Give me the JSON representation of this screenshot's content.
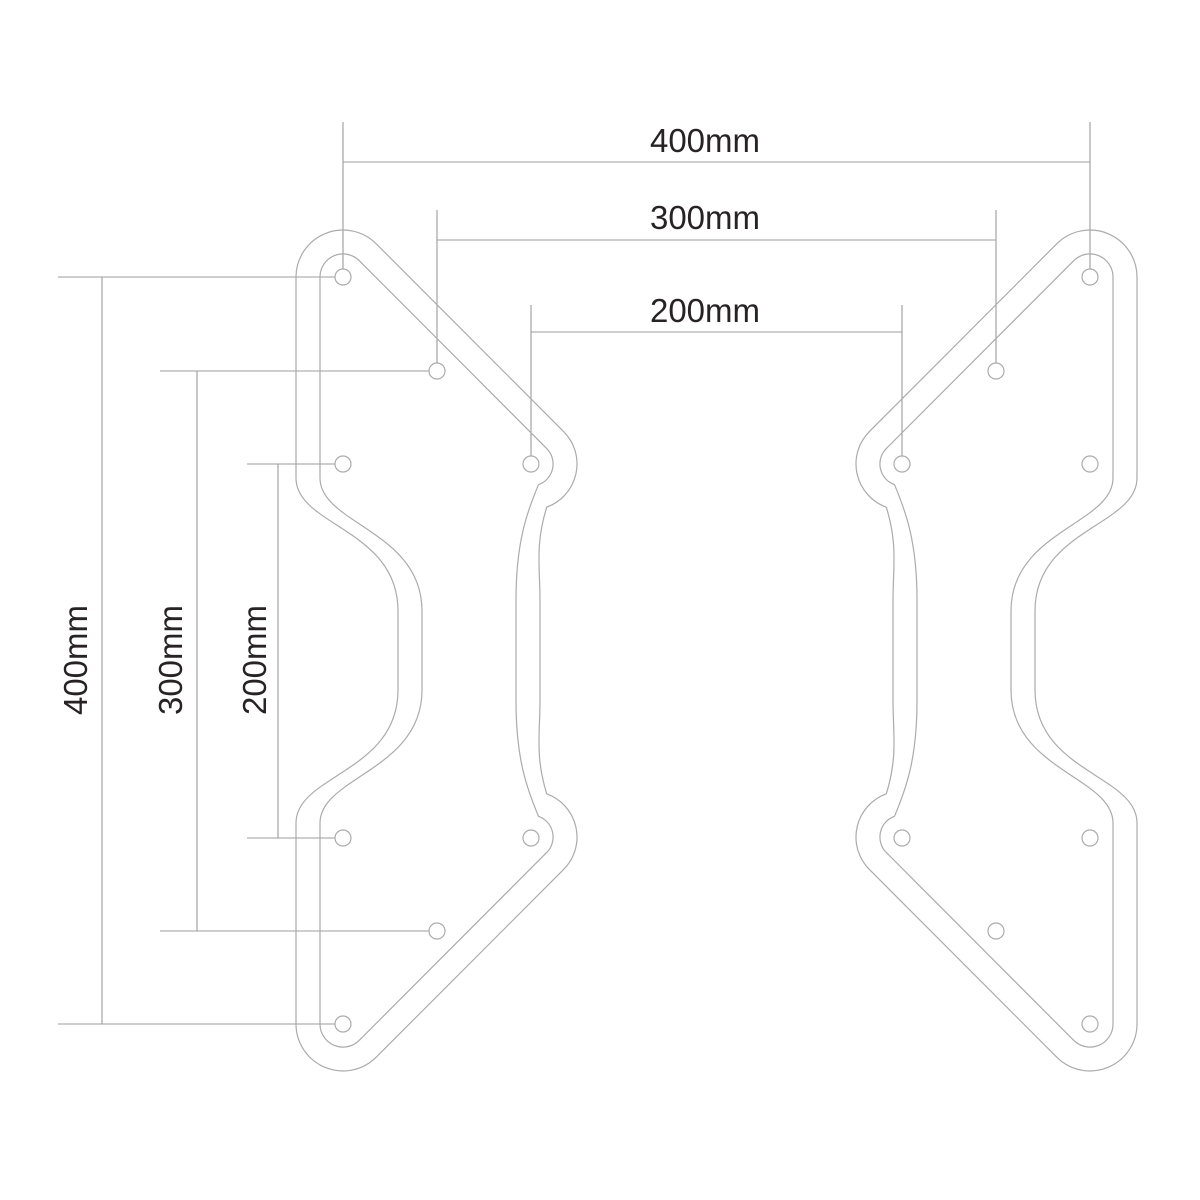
{
  "diagram": {
    "unit": "mm",
    "colors": {
      "background": "#ffffff",
      "plate_outline": "#ababab",
      "dimension_line": "#9c9c9c",
      "label_text": "#272223",
      "hole_fill": "#ffffff"
    },
    "top_dimensions": [
      {
        "label": "400mm",
        "value_mm": 400,
        "line": {
          "y": 162,
          "x1": 343,
          "x2": 1090
        },
        "extension_top_y": 122,
        "extension_bottom_y": 269
      },
      {
        "label": "300mm",
        "value_mm": 300,
        "line": {
          "y": 240,
          "x1": 437,
          "x2": 996
        },
        "extension_top_y": 210,
        "extension_bottom_y": 363
      },
      {
        "label": "200mm",
        "value_mm": 200,
        "line": {
          "y": 332,
          "x1": 531,
          "x2": 902
        },
        "extension_top_y": 305,
        "extension_bottom_y": 456
      }
    ],
    "left_dimensions": [
      {
        "label": "400mm",
        "value_mm": 400,
        "line": {
          "x": 102,
          "y1": 277,
          "y2": 1024
        },
        "extension_x1": 58,
        "extension_x2": 335
      },
      {
        "label": "300mm",
        "value_mm": 300,
        "line": {
          "x": 197,
          "y1": 371,
          "y2": 931
        },
        "extension_x1": 160,
        "extension_x2": 429
      },
      {
        "label": "200mm",
        "value_mm": 200,
        "line": {
          "x": 278,
          "y1": 464,
          "y2": 838
        },
        "extension_x1": 247,
        "extension_x2": 335
      }
    ],
    "holes": {
      "radius_px": 8,
      "left_plate": [
        [
          343,
          277
        ],
        [
          437,
          371
        ],
        [
          531,
          464
        ],
        [
          343,
          464
        ],
        [
          343,
          838
        ],
        [
          531,
          838
        ],
        [
          437,
          931
        ],
        [
          343,
          1024
        ]
      ],
      "right_plate": [
        [
          1090,
          277
        ],
        [
          996,
          371
        ],
        [
          902,
          464
        ],
        [
          1090,
          464
        ],
        [
          1090,
          838
        ],
        [
          902,
          838
        ],
        [
          996,
          931
        ],
        [
          1090,
          1024
        ]
      ]
    }
  }
}
